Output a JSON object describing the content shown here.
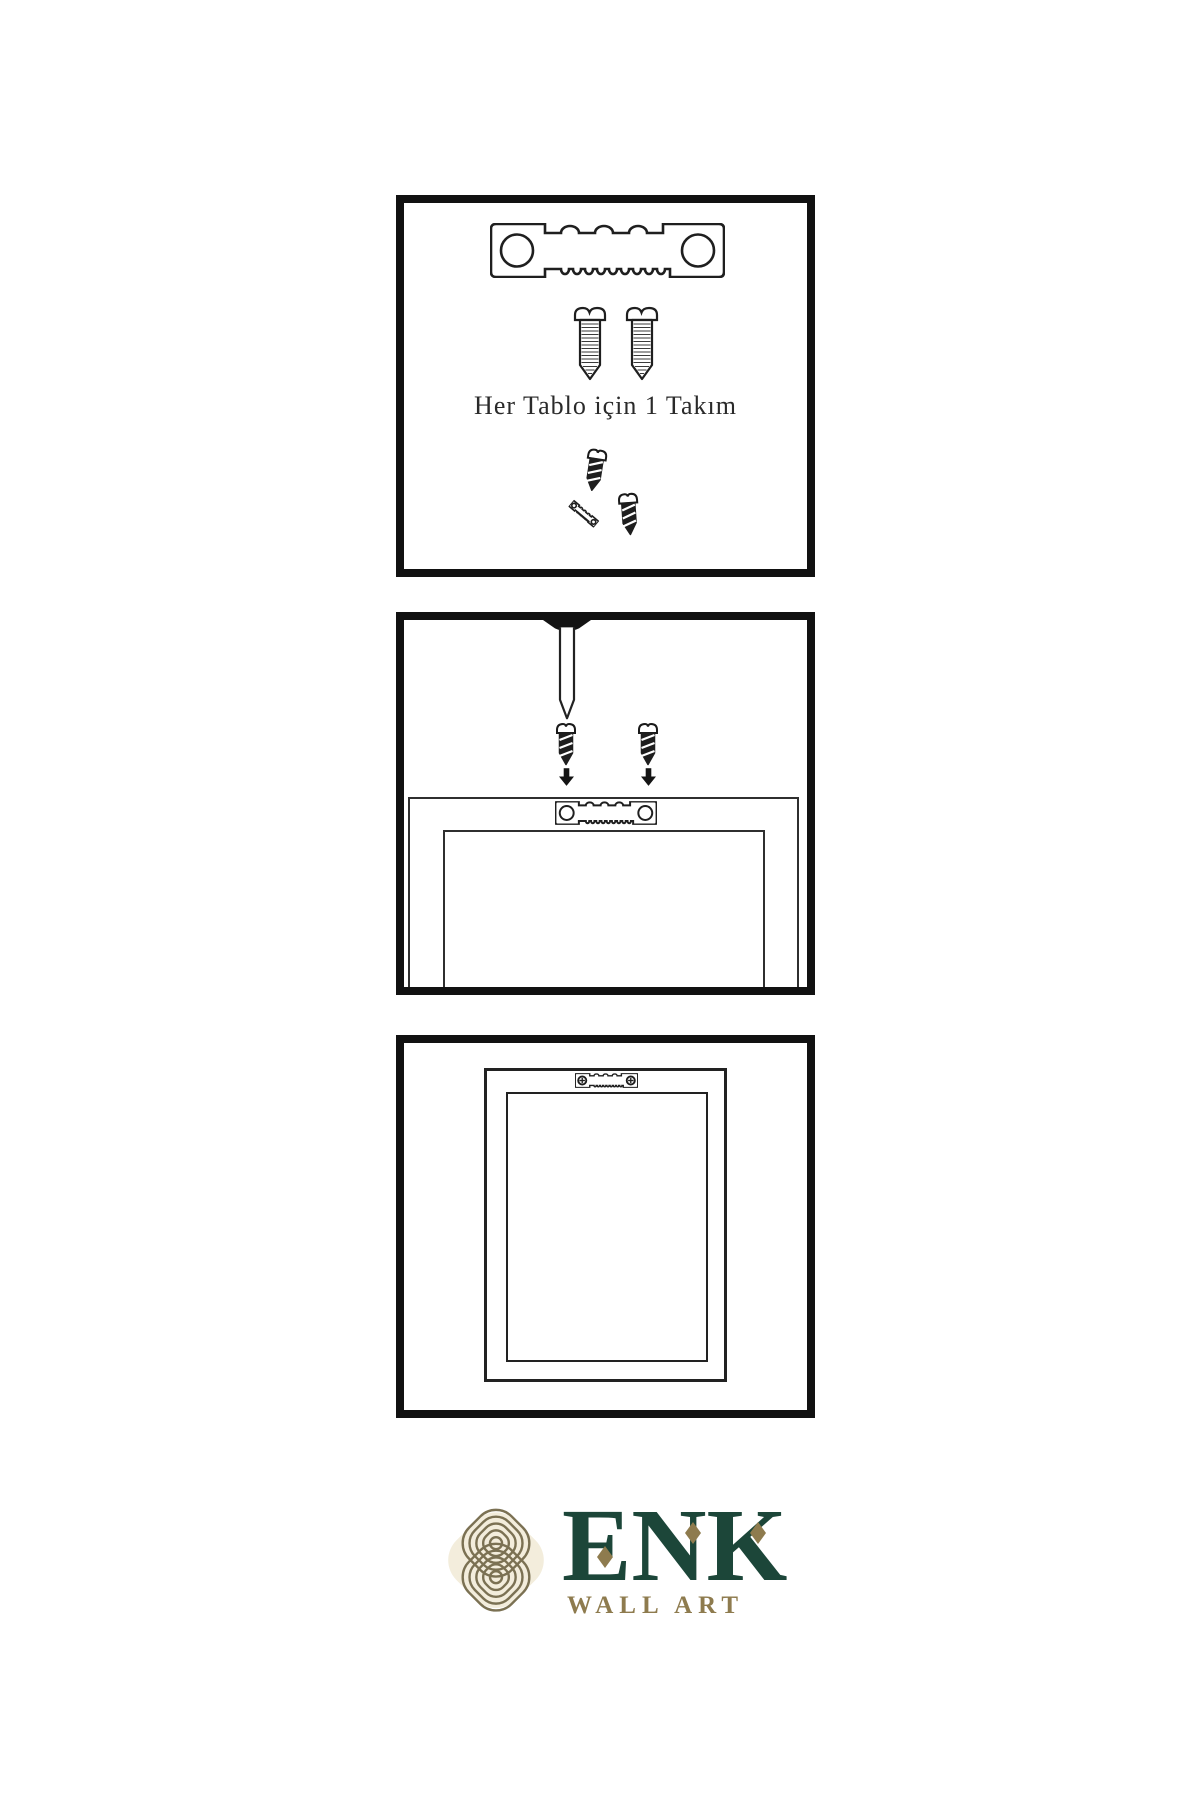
{
  "instruction": {
    "set_label": "Her Tablo için 1 Takım"
  },
  "brand": {
    "name": "ENK",
    "tagline": "WALL ART"
  },
  "colors": {
    "ink": "#1f1f1f",
    "panel_border": "#111111",
    "brand_green": "#1c4639",
    "brand_gold": "#8e7b4e",
    "knot_gold": "#7b7153",
    "knot_cream": "#f3eddc"
  }
}
